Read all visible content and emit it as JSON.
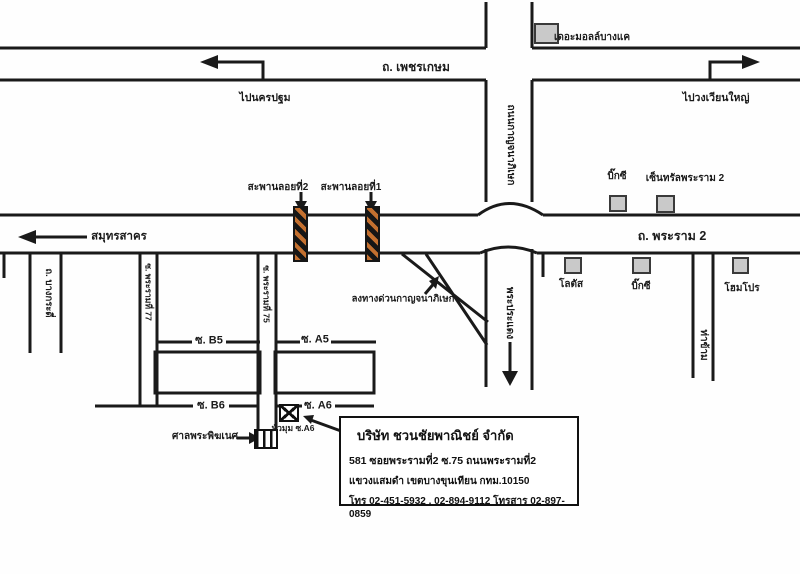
{
  "colors": {
    "line": "#1a1a1a",
    "building_fill": "#c9c9c9",
    "building_border": "#3a3a3a",
    "bridge_orange": "#c4702f"
  },
  "labels": {
    "phetkasem": "ถ. เพชรเกษม",
    "rama2": "ถ. พระราม 2",
    "to_nakhon_pathom": "ไปนครปฐม",
    "to_wongwian_yai": "ไปวงเวียนใหญ่",
    "to_samut_sakhon": "สมุทรสาคร",
    "kanchanaphisek": "ถนนกาญจนาภิเษก",
    "phra_pradaeng": "พระประแดง",
    "tha_kham": "ท่าข้าม",
    "bang_kradi": "ถ. บางกระดี่",
    "soi_rama2_77": "ซ. พระรามที่ 77",
    "soi_rama2_75": "ซ. พระรามที่ 75",
    "bridge_2": "สะพานลอยที่2",
    "bridge_1": "สะพานลอยที่1",
    "expressway_exit": "ลงทางด่วนกาญจนาภิเษก",
    "soi_b5": "ซ. B5",
    "soi_a5": "ซ. A5",
    "soi_b6": "ซ. B6",
    "soi_a6": "ซ. A6",
    "corner_a6": "หัวมุม ซ.A6",
    "shrine": "ศาลพระพิฆเนศ",
    "the_mall": "เดอะมอลล์บางแค",
    "big_c_north": "บิ๊กซี",
    "central_rama2": "เซ็นทรัลพระราม 2",
    "lotus": "โลตัส",
    "big_c_south": "บิ๊กซี",
    "homepro": "โฮมโปร"
  },
  "company": {
    "name": "บริษัท ชวนชัยพาณิชย์ จำกัด",
    "address_line1": "581 ซอยพระรามที่2 ซ.75  ถนนพระรามที่2",
    "address_line2": "แขวงแสมดำ เขตบางขุนเทียน  กทม.10150",
    "phone_line": "โทร 02-451-5932 , 02-894-9112 โทรสาร 02-897-0859"
  }
}
